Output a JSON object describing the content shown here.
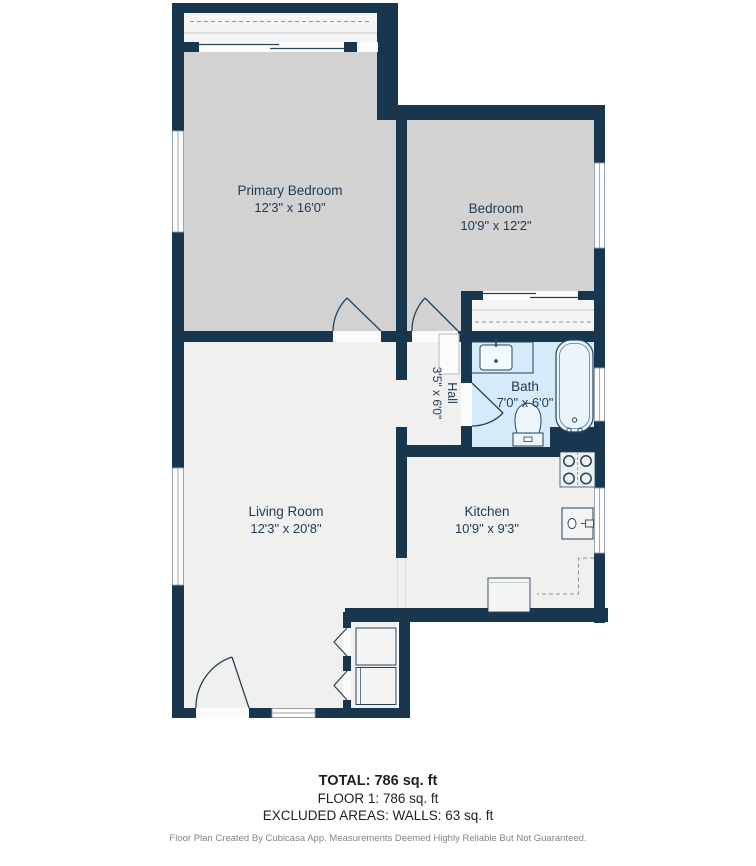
{
  "plan": {
    "rooms": [
      {
        "name": "Primary Bedroom",
        "dims": "12'3\" x 16'0\""
      },
      {
        "name": "Bedroom",
        "dims": "10'9\" x 12'2\""
      },
      {
        "name": "Hall",
        "dims": "3'5\" x 6'0\""
      },
      {
        "name": "Bath",
        "dims": "7'0\" x 6'0\""
      },
      {
        "name": "Living Room",
        "dims": "12'3\" x 20'8\""
      },
      {
        "name": "Kitchen",
        "dims": "10'9\" x 9'3\""
      }
    ],
    "colors": {
      "wall": "#18374e",
      "bedroom_floor": "#d2d2d3",
      "floor_light": "#f0f0ef",
      "closet_floor": "#f4f5f4",
      "bath_floor": "#d5ebf9",
      "label": "#1d3b54"
    }
  },
  "summary": {
    "total": "TOTAL: 786 sq. ft",
    "floor": "FLOOR 1: 786 sq. ft",
    "excluded": "EXCLUDED AREAS: WALLS: 63 sq. ft"
  },
  "footer": {
    "credit": "Floor Plan Created By Cubicasa App. Measurements Deemed Highly Reliable But Not Guaranteed."
  }
}
